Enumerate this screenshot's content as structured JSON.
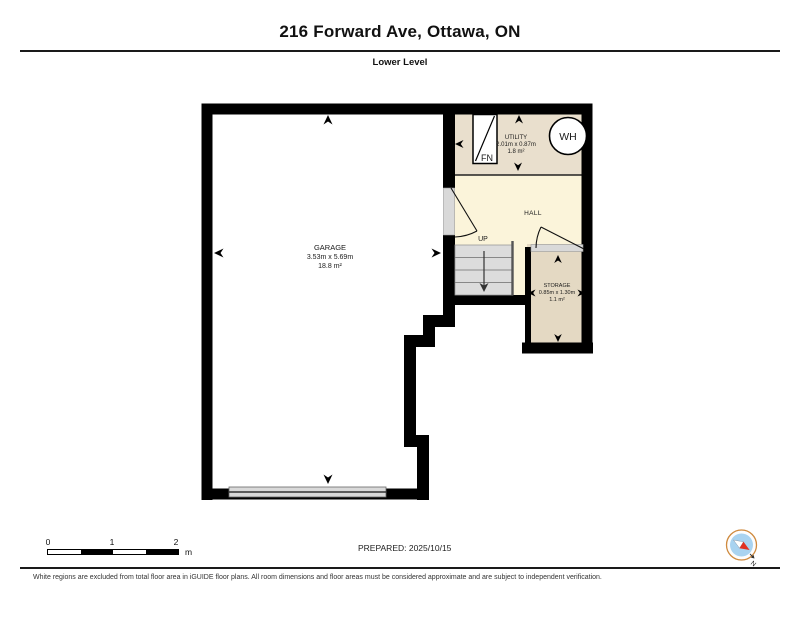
{
  "header": {
    "title": "216 Forward Ave, Ottawa, ON",
    "level": "Lower Level"
  },
  "plan": {
    "garage": {
      "name": "GARAGE",
      "dims": "3.53m x 5.69m",
      "area": "18.8 m²"
    },
    "utility": {
      "name": "UTILITY",
      "dims": "2.01m x 0.87m",
      "area": "1.8 m²"
    },
    "hall": {
      "name": "HALL"
    },
    "storage": {
      "name": "STORAGE",
      "dims": "0.85m x 1.30m",
      "area": "1.1 m²"
    },
    "stairs_label": "UP",
    "furnace_label": "FN",
    "water_heater_label": "WH"
  },
  "footer": {
    "prepared": "PREPARED: 2025/10/15",
    "scale": {
      "t0": "0",
      "t1": "1",
      "t2": "2",
      "unit": "m"
    },
    "compass_north": "N",
    "disclaimer": "White regions are excluded from total floor area in iGUIDE floor plans. All room dimensions and floor areas must be considered approximate and are subject to independent verification."
  },
  "colors": {
    "wall": "#000000",
    "utility_floor": "#e9dfcd",
    "hall_floor": "#fbf4da",
    "storage_floor": "#e4d9c3",
    "stairs": "#dcdcdc",
    "door_opening": "#d9d9d9",
    "compass_blue": "#a9d3f0",
    "compass_red": "#e23122"
  }
}
